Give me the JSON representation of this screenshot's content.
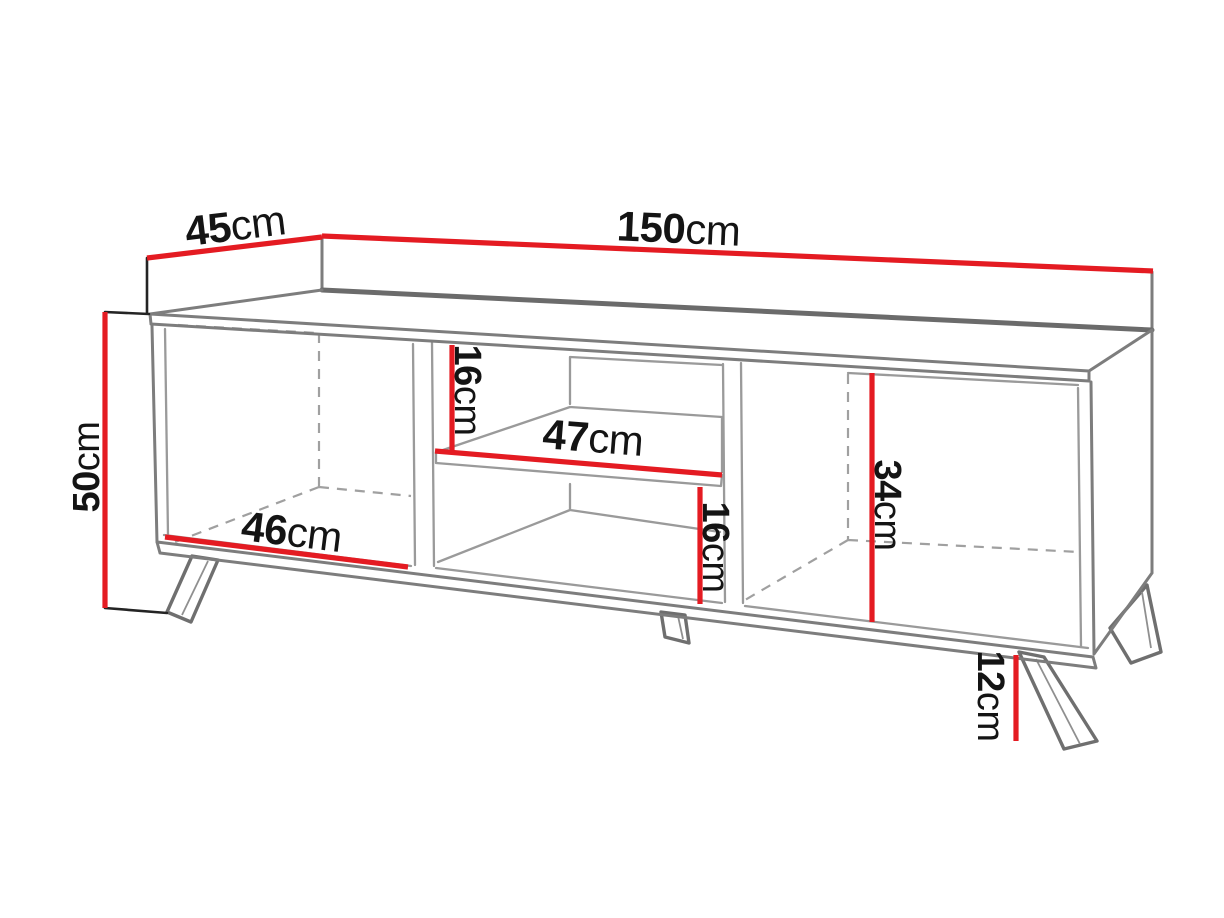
{
  "diagram": {
    "kind": "furniture-dimension-diagram",
    "dimensions": {
      "depth": {
        "value": "45",
        "unit": "cm"
      },
      "width": {
        "value": "150",
        "unit": "cm"
      },
      "height": {
        "value": "50",
        "unit": "cm"
      },
      "upper_shelf_gap": {
        "value": "16",
        "unit": "cm"
      },
      "shelf_width": {
        "value": "47",
        "unit": "cm"
      },
      "left_compartment_width": {
        "value": "46",
        "unit": "cm"
      },
      "lower_shelf_gap": {
        "value": "16",
        "unit": "cm"
      },
      "side_compartment_height": {
        "value": "34",
        "unit": "cm"
      },
      "leg_height": {
        "value": "12",
        "unit": "cm"
      }
    },
    "colors": {
      "dimension_red": "#e41b22",
      "outline_gray": "#7d7d7d",
      "outline_dark": "#6b6b6b",
      "interior_gray": "#9a9a9a",
      "witness_black": "#242424",
      "label_text": "#141414",
      "background": "#ffffff"
    }
  }
}
